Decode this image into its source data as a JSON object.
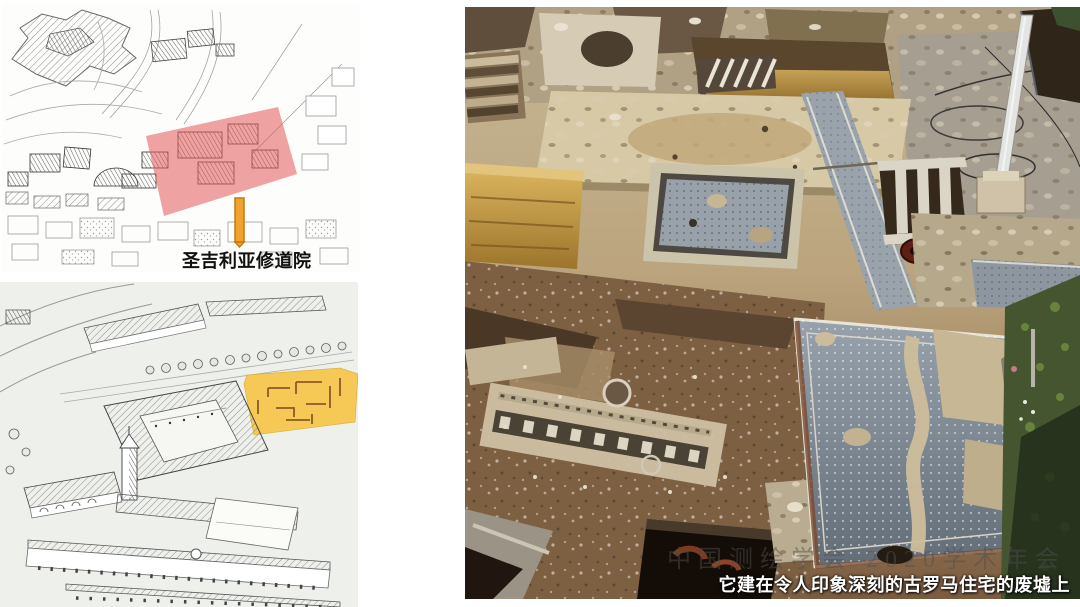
{
  "slide": {
    "caption": "它建在令人印象深刻的古罗马住宅的废墟上",
    "watermark": "中国测绘学会 2020学术年会"
  },
  "maps": {
    "top_label": "圣吉利亚修道院"
  },
  "colors": {
    "highlight-red": "#e15a5a",
    "highlight-yellow": "#f6c64e",
    "pointer-orange": "#f2a230",
    "pointer-orange-border": "#bd7d15",
    "caption-text": "#ffffff",
    "watermark-text": "#4f4f4f",
    "label-text": "#111111"
  }
}
